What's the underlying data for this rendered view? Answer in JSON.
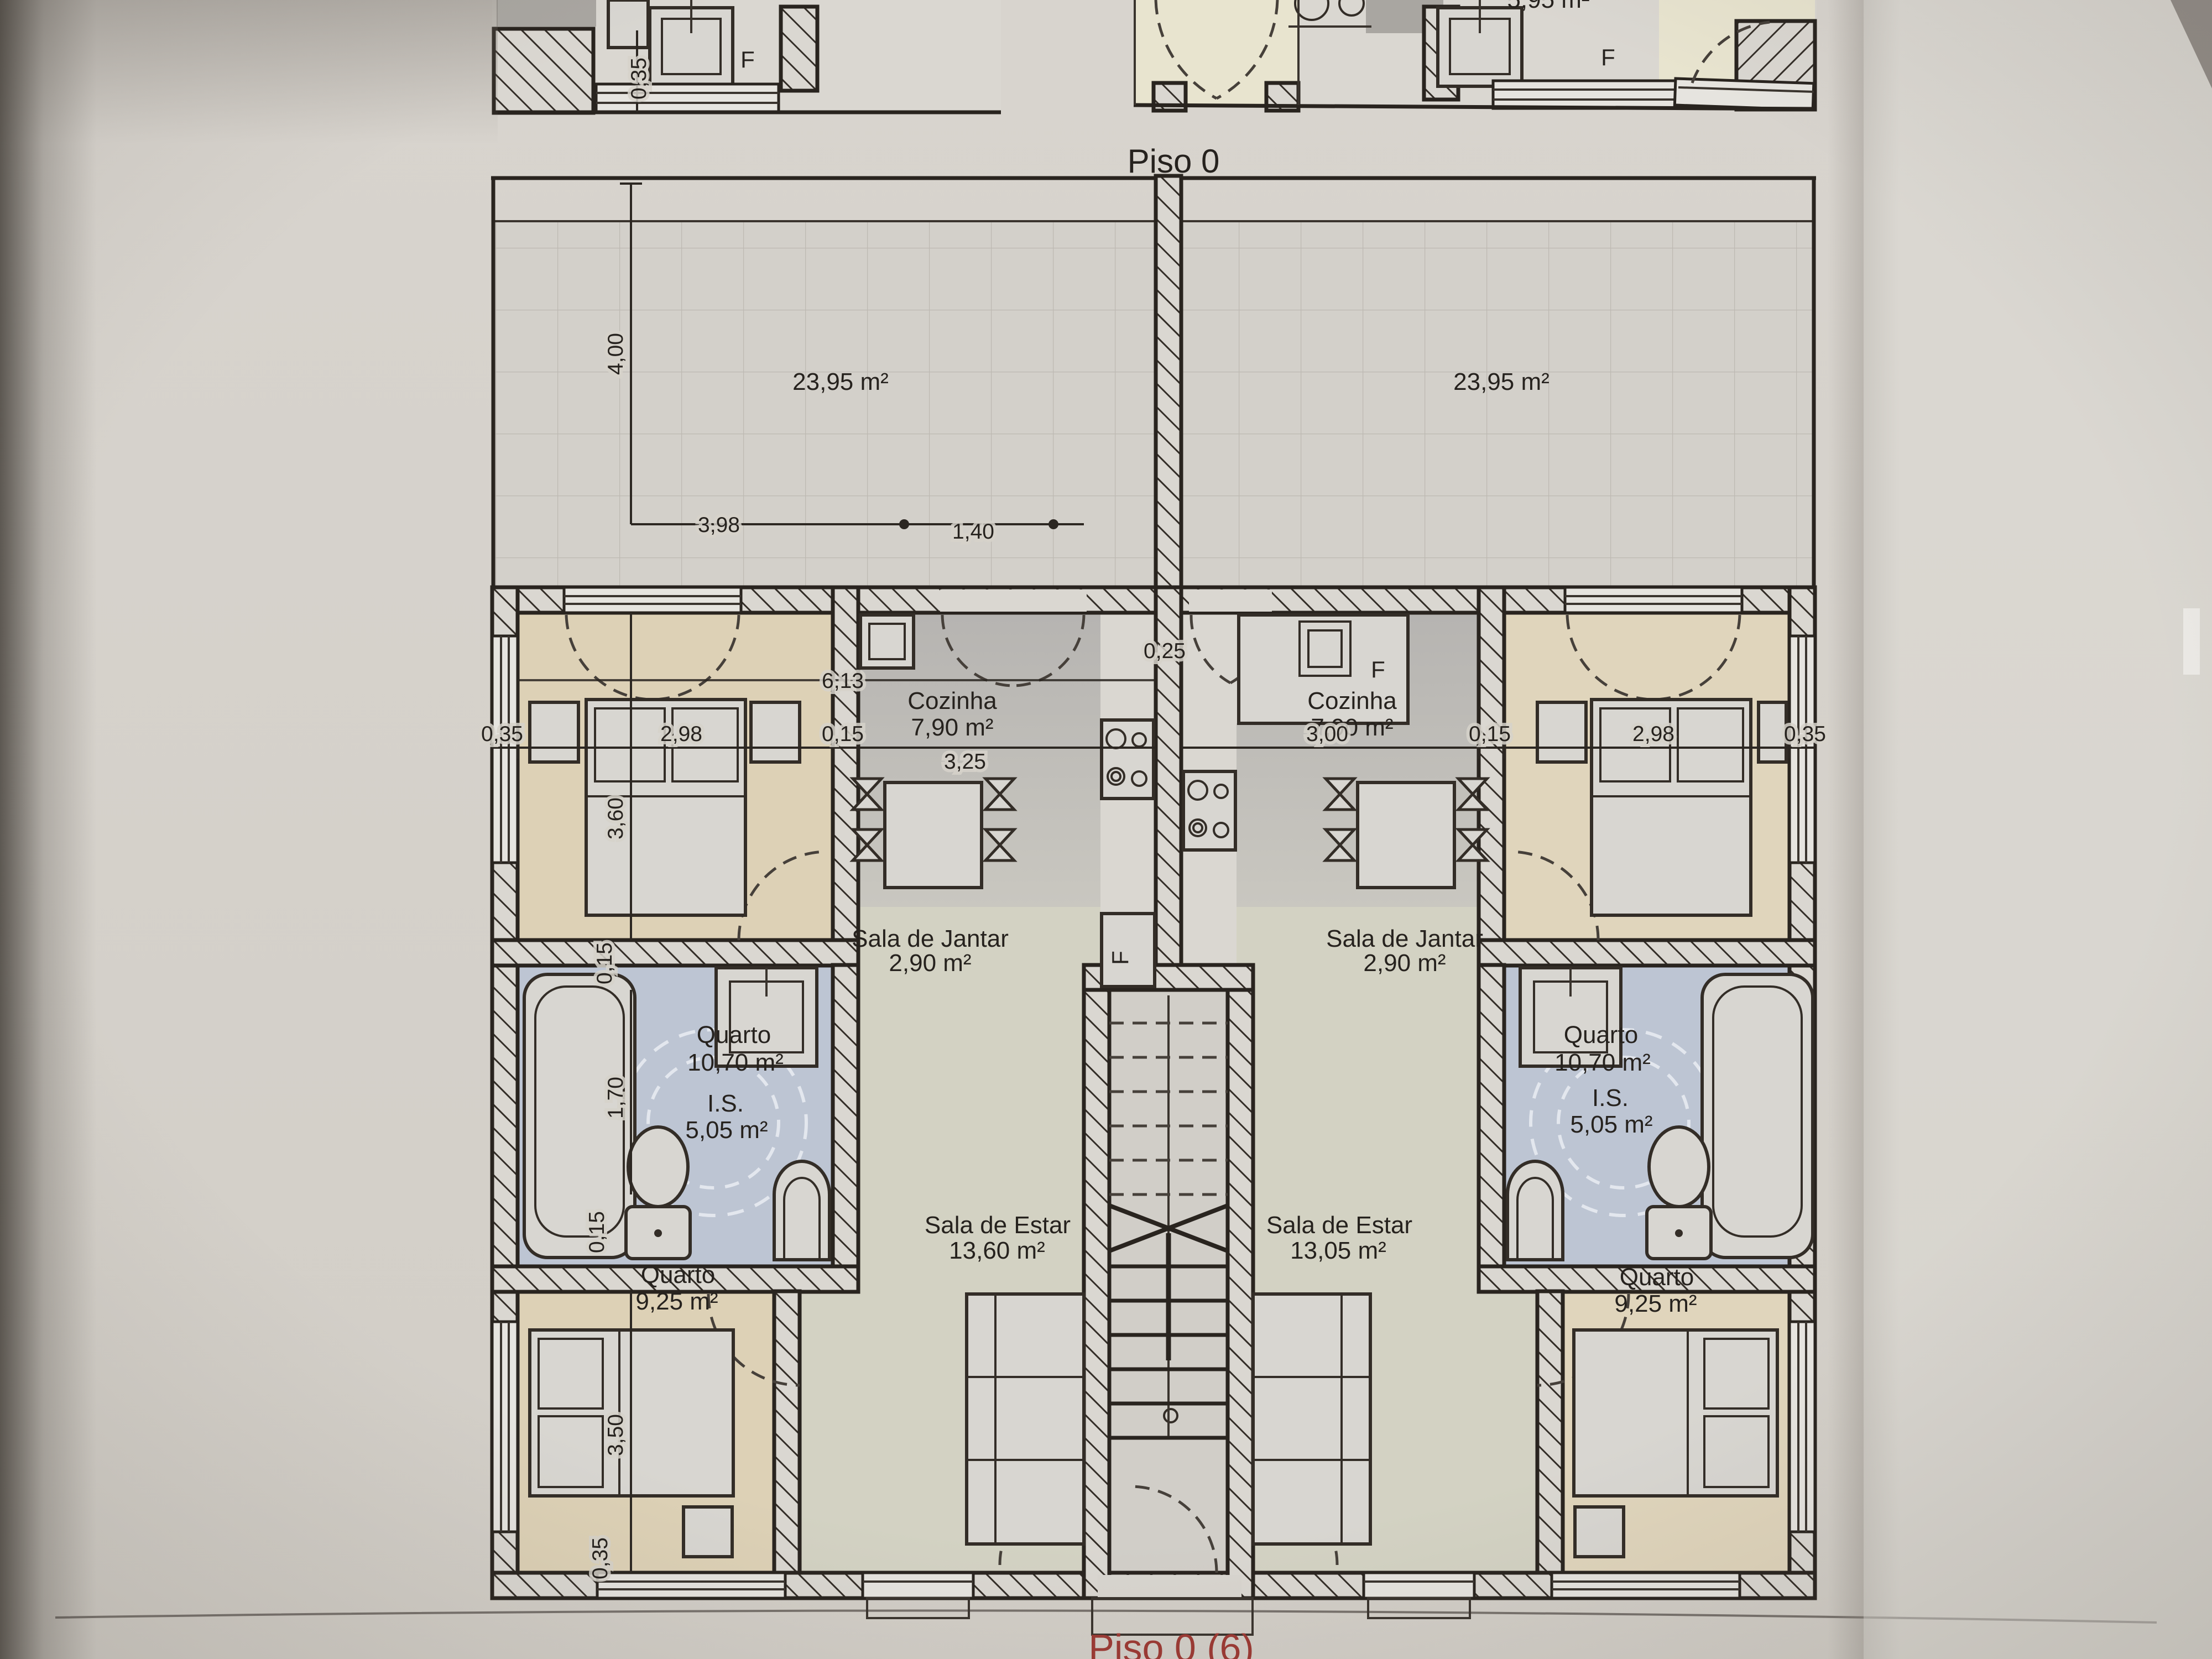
{
  "plan": {
    "title": "Piso 0"
  },
  "photo": {
    "footer_label": "Piso 0 (6)"
  },
  "upper_fragment": {
    "fridge_left": "F",
    "fridge_right": "F",
    "dim_wall": "0,35",
    "partial_area": "5,95 m²"
  },
  "terrace": {
    "left_area": "23,95 m²",
    "right_area": "23,95 m²"
  },
  "left_apartment": {
    "cozinha": "Cozinha",
    "cozinha_area": "7,90 m²",
    "jantar": "Sala de Jantar",
    "jantar_area": "2,90 m²",
    "quarto1": "Quarto",
    "quarto1_area": "10,70 m²",
    "is": "I.S.",
    "is_area": "5,05 m²",
    "estar": "Sala de Estar",
    "estar_area": "13,60 m²",
    "quarto2": "Quarto",
    "quarto2_area": "9,25 m²",
    "fridge": "F"
  },
  "right_apartment": {
    "cozinha": "Cozinha",
    "cozinha_area": "7,90 m²",
    "jantar": "Sala de Jantar",
    "jantar_area": "2,90 m²",
    "quarto1": "Quarto",
    "quarto1_area": "10,70 m²",
    "is": "I.S.",
    "is_area": "5,05 m²",
    "estar": "Sala de Estar",
    "estar_area": "13,05 m²",
    "quarto2": "Quarto",
    "quarto2_area": "9,25 m²",
    "fridge": "F"
  },
  "dims": {
    "w035_top": "0,35",
    "h400": "4,00",
    "w398": "3,98",
    "w140": "1,40",
    "l035": "0,35",
    "l298": "2,98",
    "l015": "0,15",
    "k613": "6,13",
    "k325": "3,25",
    "k025": "0,25",
    "r300": "3,00",
    "r015": "0,15",
    "r298": "2,98",
    "r035": "0,35",
    "v360": "3,60",
    "v170": "1,70",
    "v015a": "0,15",
    "v015b": "0,15",
    "v350": "3,50",
    "v035": "0,35"
  }
}
